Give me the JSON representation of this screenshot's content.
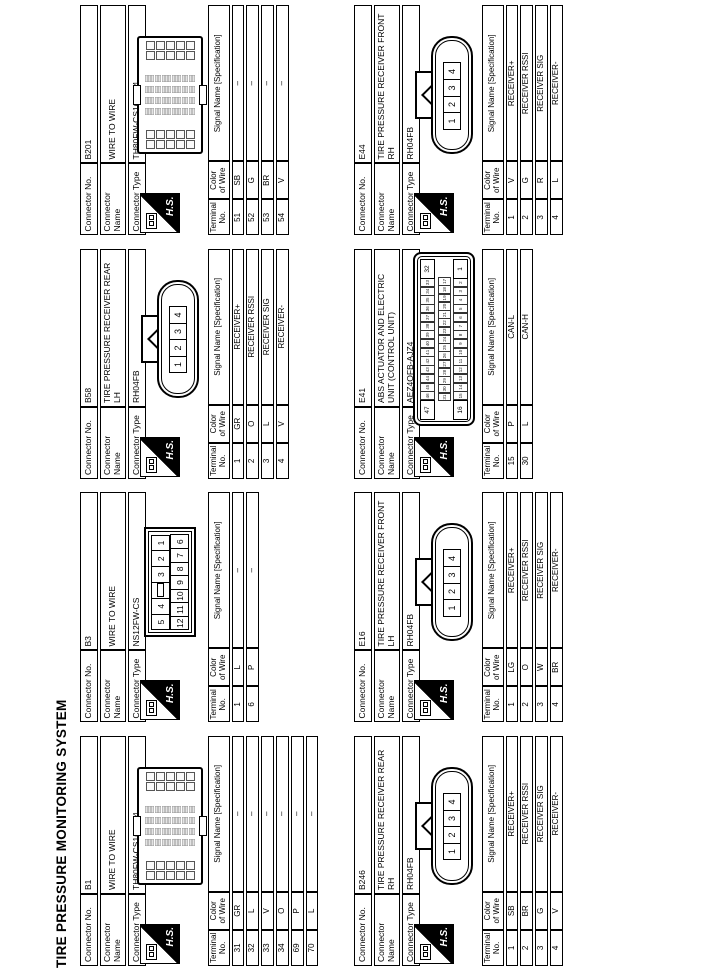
{
  "page_title": "TIRE PRESSURE MONITORING SYSTEM",
  "labels": {
    "connector_no": "Connector No.",
    "connector_name": "Connector Name",
    "connector_type": "Connector Type",
    "hs": "H.S.",
    "terminal_headers": {
      "terminal": [
        "Terminal",
        "No."
      ],
      "color": [
        "Color",
        "of Wire"
      ],
      "signal": [
        "Signal Name [Specification]"
      ]
    }
  },
  "blocks": [
    {
      "connector_no": "B1",
      "connector_name": "WIRE TO WIRE",
      "connector_type": "TH80FW-CS16-TM4",
      "row": 0,
      "col": 0,
      "drawing": {
        "type": "th80"
      },
      "terminals": [
        {
          "no": "31",
          "color": "GR",
          "signal": "–"
        },
        {
          "no": "32",
          "color": "L",
          "signal": "–"
        },
        {
          "no": "33",
          "color": "V",
          "signal": "–"
        },
        {
          "no": "34",
          "color": "O",
          "signal": "–"
        },
        {
          "no": "69",
          "color": "P",
          "signal": "–"
        },
        {
          "no": "70",
          "color": "L",
          "signal": "–"
        }
      ]
    },
    {
      "connector_no": "B3",
      "connector_name": "WIRE TO WIRE",
      "connector_type": "NS12FW-CS",
      "row": 0,
      "col": 1,
      "drawing": {
        "type": "ns12",
        "rows": [
          [
            "5",
            "4",
            "",
            "3",
            "2",
            "1"
          ],
          [
            "12",
            "11",
            "10",
            "9",
            "8",
            "7",
            "6"
          ]
        ]
      },
      "terminals": [
        {
          "no": "1",
          "color": "L",
          "signal": "–"
        },
        {
          "no": "6",
          "color": "P",
          "signal": "–"
        }
      ]
    },
    {
      "connector_no": "B58",
      "connector_name": "TIRE PRESSURE RECEIVER REAR LH",
      "connector_type": "RH04FB",
      "row": 0,
      "col": 2,
      "drawing": {
        "type": "rh04fb",
        "pins": [
          "1",
          "2",
          "3",
          "4"
        ]
      },
      "terminals": [
        {
          "no": "1",
          "color": "GR",
          "signal": "RECEIVER+"
        },
        {
          "no": "2",
          "color": "O",
          "signal": "RECEIVER RSSI"
        },
        {
          "no": "3",
          "color": "L",
          "signal": "RECEIVER SIG"
        },
        {
          "no": "4",
          "color": "V",
          "signal": "RECEIVER-"
        }
      ]
    },
    {
      "connector_no": "B201",
      "connector_name": "WIRE TO WIRE",
      "connector_type": "TH80FW-CS16-TM4",
      "row": 0,
      "col": 3,
      "drawing": {
        "type": "th80"
      },
      "terminals": [
        {
          "no": "51",
          "color": "SB",
          "signal": "–"
        },
        {
          "no": "52",
          "color": "G",
          "signal": "–"
        },
        {
          "no": "53",
          "color": "BR",
          "signal": "–"
        },
        {
          "no": "54",
          "color": "V",
          "signal": "–"
        }
      ]
    },
    {
      "connector_no": "B246",
      "connector_name": "TIRE PRESSURE RECEIVER REAR RH",
      "connector_type": "RH04FB",
      "row": 1,
      "col": 0,
      "drawing": {
        "type": "rh04fb",
        "pins": [
          "1",
          "2",
          "3",
          "4"
        ]
      },
      "terminals": [
        {
          "no": "1",
          "color": "SB",
          "signal": "RECEIVER+"
        },
        {
          "no": "2",
          "color": "BR",
          "signal": "RECEIVER RSSI"
        },
        {
          "no": "3",
          "color": "G",
          "signal": "RECEIVER SIG"
        },
        {
          "no": "4",
          "color": "V",
          "signal": "RECEIVER-"
        }
      ]
    },
    {
      "connector_no": "E16",
      "connector_name": "TIRE PRESSURE RECEIVER FRONT LH",
      "connector_type": "RH04FB",
      "row": 1,
      "col": 1,
      "drawing": {
        "type": "rh04fb",
        "pins": [
          "1",
          "2",
          "3",
          "4"
        ]
      },
      "terminals": [
        {
          "no": "1",
          "color": "LG",
          "signal": "RECEIVER+"
        },
        {
          "no": "2",
          "color": "O",
          "signal": "RECEIVER RSSI"
        },
        {
          "no": "3",
          "color": "W",
          "signal": "RECEIVER SIG"
        },
        {
          "no": "4",
          "color": "BR",
          "signal": "RECEIVER-"
        }
      ]
    },
    {
      "connector_no": "E41",
      "connector_name": "ABS ACTUATOR AND ELECTRIC UNIT (CONTROL UNIT)",
      "connector_type": "AEZ4QFB-AJZ4",
      "row": 1,
      "col": 2,
      "drawing": {
        "type": "abs47",
        "corners": {
          "top_left": "47",
          "top_right": "32",
          "bottom_left": "16",
          "bottom_right": "1"
        },
        "top_pins": [
          "46",
          "45",
          "44",
          "43",
          "42",
          "41",
          "40",
          "39",
          "38",
          "37",
          "36",
          "35",
          "34",
          "33"
        ],
        "mid_pins": [
          "31",
          "30",
          "29",
          "28",
          "27",
          "26",
          "25",
          "24",
          "23",
          "22",
          "21",
          "20",
          "19",
          "18",
          "17"
        ],
        "bottom_pins": [
          "15",
          "14",
          "13",
          "12",
          "11",
          "10",
          "9",
          "8",
          "7",
          "6",
          "5",
          "4",
          "3",
          "2"
        ]
      },
      "terminals": [
        {
          "no": "15",
          "color": "P",
          "signal": "CAN-L"
        },
        {
          "no": "30",
          "color": "L",
          "signal": "CAN-H"
        }
      ]
    },
    {
      "connector_no": "E44",
      "connector_name": "TIRE PRESSURE RECEIVER FRONT RH",
      "connector_type": "RH04FB",
      "row": 1,
      "col": 3,
      "drawing": {
        "type": "rh04fb",
        "pins": [
          "1",
          "2",
          "3",
          "4"
        ]
      },
      "terminals": [
        {
          "no": "1",
          "color": "V",
          "signal": "RECEIVER+"
        },
        {
          "no": "2",
          "color": "G",
          "signal": "RECEIVER RSSI"
        },
        {
          "no": "3",
          "color": "R",
          "signal": "RECEIVER SIG"
        },
        {
          "no": "4",
          "color": "L",
          "signal": "RECEIVER-"
        }
      ]
    }
  ]
}
